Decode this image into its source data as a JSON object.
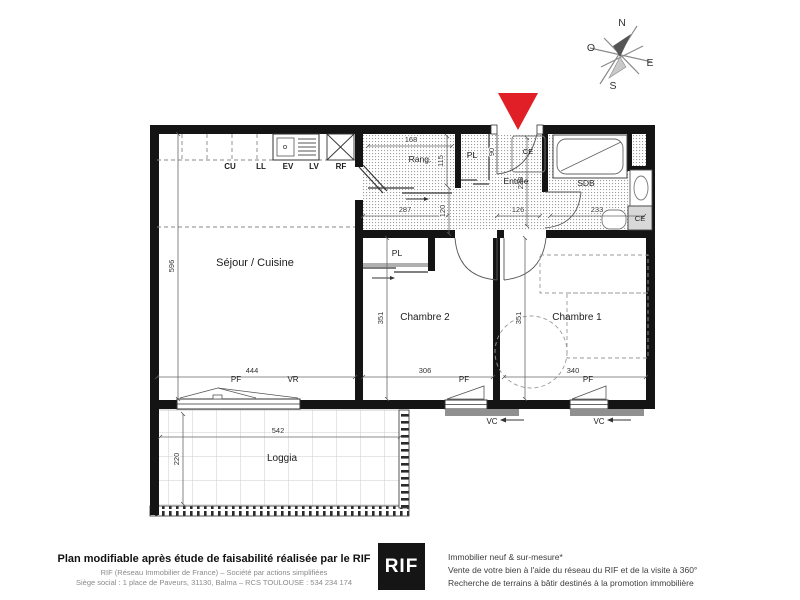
{
  "colors": {
    "accent_red": "#e01f26",
    "wall_black": "#141414"
  },
  "compass": {
    "north": "N",
    "west": "O",
    "east": "E",
    "south": "S"
  },
  "rooms": {
    "sejour": "Séjour / Cuisine",
    "chambre1": "Chambre 1",
    "chambre2": "Chambre 2",
    "loggia": "Loggia",
    "entree": "Entrée",
    "sdb": "SDB",
    "rang": "Rang."
  },
  "closets": {
    "pl_hall": "PL",
    "pl_chambre2": "PL",
    "ce_entree": "CE",
    "ce_sdb": "CE"
  },
  "kitchen_units": {
    "cu": "CU",
    "ll": "LL",
    "ev": "EV",
    "lv": "LV",
    "rf": "RF"
  },
  "window_labels": {
    "pf_sejour": "PF",
    "vr_sejour": "VR",
    "pf_chambre2": "PF",
    "vc_chambre2": "VC",
    "pf_chambre1": "PF",
    "vc_chambre1": "VC"
  },
  "dims": {
    "d596": "596",
    "d444": "444",
    "d287": "287",
    "d120": "120",
    "d115": "115",
    "d168": "168",
    "d90": "90",
    "d126": "126",
    "d238": "238",
    "d233": "233",
    "d351a": "351",
    "d306": "306",
    "d351b": "351",
    "d340": "340",
    "d542": "542",
    "d220": "220"
  },
  "footer": {
    "left_title": "Plan modifiable après étude de faisabilité réalisée par le RIF",
    "left_line2": "RIF (Réseau Immobilier de France) – Société par actions simplifiées",
    "left_line3": "Siège social : 1 place de Paveurs, 31130, Balma – RCS TOULOUSE : 534 234 174",
    "logo_text": "RIF",
    "right_line1": "Immobilier neuf & sur-mesure*",
    "right_line2": "Vente de votre bien à l'aide du réseau du RIF et de la visite à 360°",
    "right_line3": "Recherche de terrains à bâtir destinés à la promotion immobilière"
  }
}
